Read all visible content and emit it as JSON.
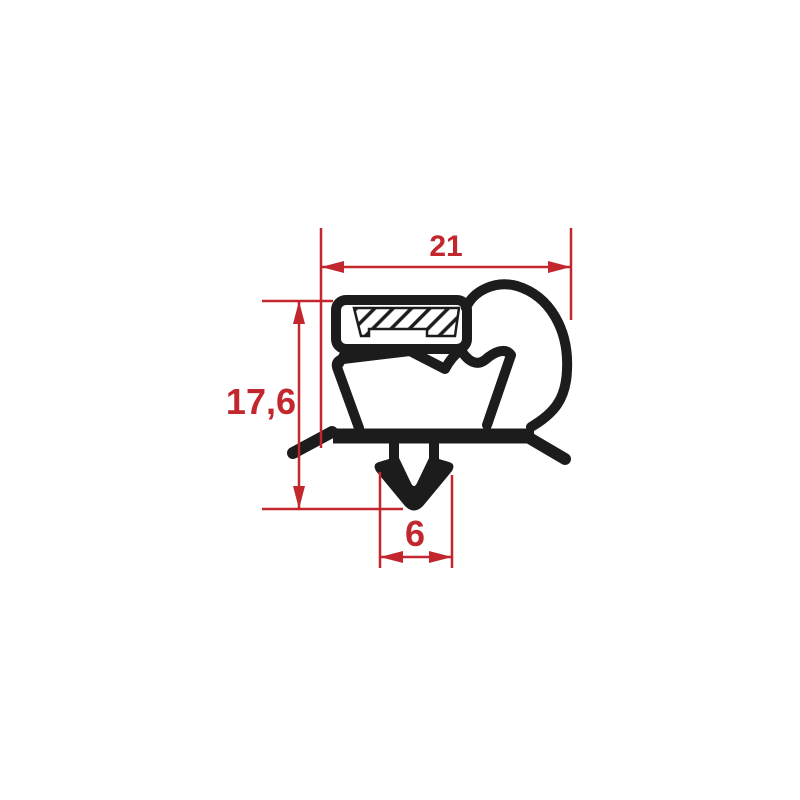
{
  "drawing": {
    "subject": "door-gasket-profile-cross-section",
    "dimension_labels": {
      "width": "21",
      "height": "17,6",
      "foot_width": "6"
    },
    "colors": {
      "dimension_red": "#c1272d",
      "profile_black": "#1c1c1c",
      "background": "#ffffff"
    }
  }
}
